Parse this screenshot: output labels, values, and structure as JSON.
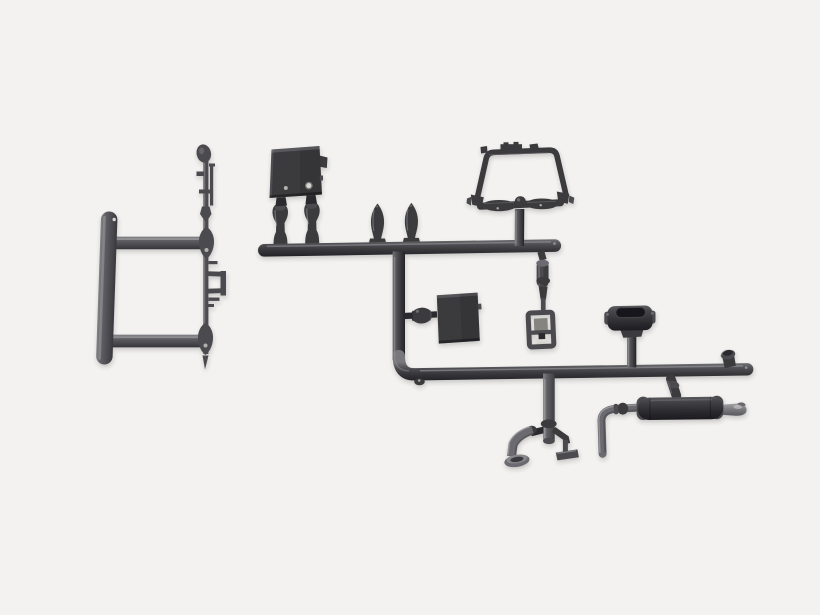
{
  "meta": {
    "alt": "Photo of dark grey plastic model kit parts attached to sprue runners on a light background"
  },
  "palette": {
    "bg": "#f3f2f0",
    "tube": [
      "#77777b",
      "#55555a",
      "#38383c",
      "#222226"
    ],
    "frame": [
      "#909094",
      "#606065",
      "#46464b",
      "#303035"
    ],
    "cyl": [
      "#88888c",
      "#5e5e62",
      "#3c3c40"
    ],
    "muffler": [
      "#5e5e62",
      "#45454a",
      "#2e2e32",
      "#1c1c20"
    ],
    "tip": [
      "#ababae",
      "#7d7d81",
      "#56565a"
    ],
    "plastic_dark": "#3a3a3e",
    "plastic_darker": "#2a2a2e",
    "plastic_mid": "#4b4b50",
    "plastic_soft": "#6b6b6f",
    "edge_highlight": "#a0a0a3",
    "hole_bright": "#d8d6d2",
    "hole_dim": "#b2b0ac",
    "hole_ring": "#7b7a76",
    "opening": "#17171a",
    "window_shaded": "#85847f",
    "window_bright": "#dcdad5",
    "shadow_color": "#35353a"
  },
  "parts": [
    {
      "name": "bumper-frame",
      "label": "H-shaped bumper frame part"
    },
    {
      "name": "small-parts-runner",
      "label": "Thin runner with mirror knob, linkages and clamp"
    },
    {
      "name": "battery-box",
      "label": "Battery box part with two holes"
    },
    {
      "name": "exhaust-stack-a",
      "label": "Exhaust stack part A"
    },
    {
      "name": "exhaust-stack-b",
      "label": "Exhaust stack part B"
    },
    {
      "name": "air-horn-a",
      "label": "Pointed valve part A"
    },
    {
      "name": "air-horn-b",
      "label": "Pointed valve part B"
    },
    {
      "name": "upper-runner",
      "label": "Upper sprue runner bar"
    },
    {
      "name": "roll-bar",
      "label": "Roll bar hoop with spreader bar"
    },
    {
      "name": "main-runner",
      "label": "Main L-shaped sprue runner"
    },
    {
      "name": "fuel-tank",
      "label": "Fuel tank box part"
    },
    {
      "name": "shock-absorber",
      "label": "Shock absorber linkage"
    },
    {
      "name": "bracket-frame",
      "label": "Open bracket frame part"
    },
    {
      "name": "air-cleaner",
      "label": "Air cleaner housing part"
    },
    {
      "name": "filler-cap",
      "label": "Filler cap part"
    },
    {
      "name": "muffler",
      "label": "Muffler with exhaust tip"
    },
    {
      "name": "tail-pipe",
      "label": "Bent tail pipe part"
    },
    {
      "name": "downpipe",
      "label": "Downpipe assembly with mounting feet"
    }
  ]
}
